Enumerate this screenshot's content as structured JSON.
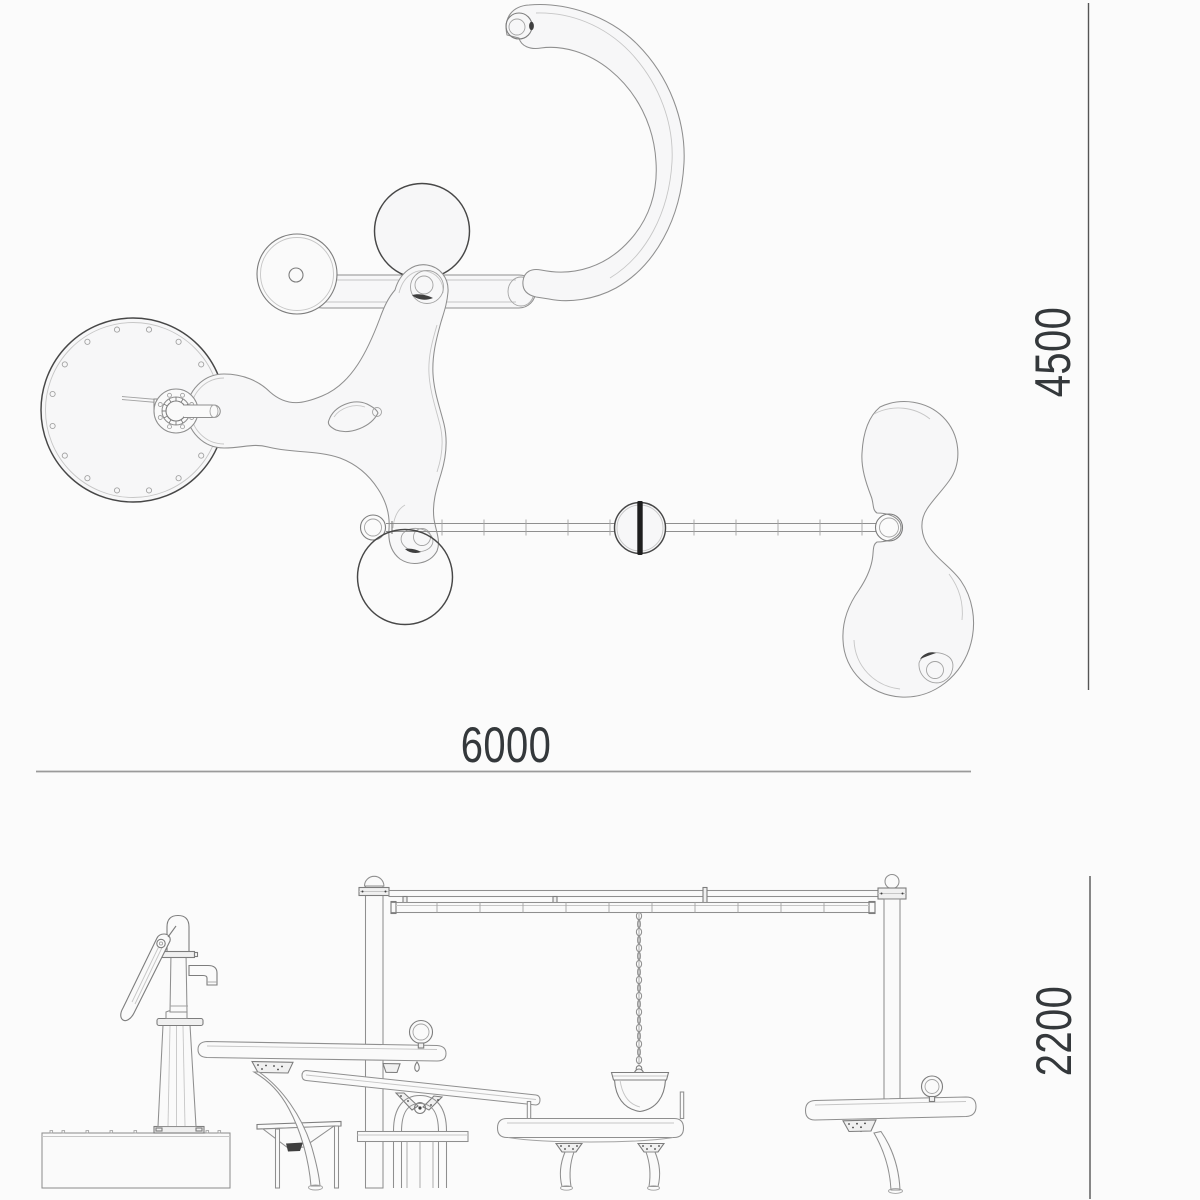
{
  "colors": {
    "background": "#fbfbfb",
    "shape_fill": "#f7f7f8",
    "line": "#8f8f8f",
    "line_dark": "#474747",
    "dim_line": "#9a9a9a",
    "dim_line_dark": "#555555",
    "dim_text": "#34383b"
  },
  "plan_view": {
    "width_dimension": "6000",
    "height_dimension": "4500"
  },
  "elevation_view": {
    "height_dimension": "2200"
  }
}
